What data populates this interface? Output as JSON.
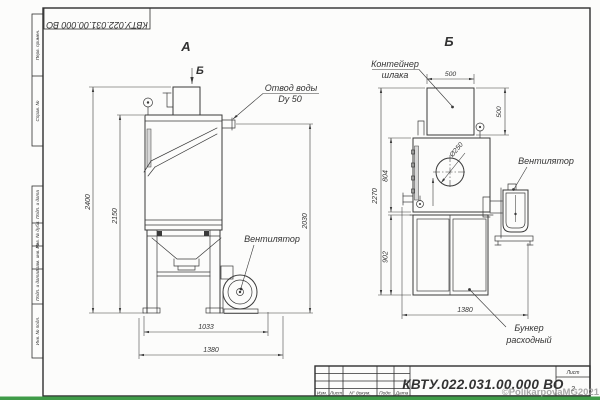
{
  "colors": {
    "line": "#3a3a3a",
    "green_bar": "#3f9b48"
  },
  "frame": {
    "top_stamp_code": "КВТУ.022.031.00.000  ВО",
    "left_top": [
      "Перв. примен.",
      "Справ. №"
    ],
    "left_bottom": [
      "Подп. и дата",
      "Инв. № дубл.",
      "Взам. инв. №",
      "Подп. и дата",
      "Инв. № подл."
    ]
  },
  "title_block": {
    "columns": [
      "Изм.",
      "Лист",
      "N° докум.",
      "Подп.",
      "Дата"
    ],
    "code": "КВТУ.022.031.00.000  ВО",
    "sheet_label": "Лист",
    "sheet_number": "2"
  },
  "watermark": "©PolikarpovaMG2021",
  "view_a": {
    "label": "А",
    "section_callout": "Б",
    "water_outlet": {
      "line1": "Отвод воды",
      "line2": "Dy 50"
    },
    "fan_label": "Вентилятор",
    "dim_total_height": "2400",
    "dim_tank_height": "2150",
    "dim_right_height": "2030",
    "dim_width_inner": "1033",
    "dim_width_total": "1380"
  },
  "view_b": {
    "label": "Б",
    "container": {
      "line1": "Контейнер",
      "line2": "шлака"
    },
    "fan_label": "Вентилятор",
    "bunker": {
      "line1": "Бункер",
      "line2": "расходный"
    },
    "dim_container_width": "500",
    "dim_container_height": "500",
    "dim_hole_diameter": "Ø250",
    "dim_body_height": "804",
    "dim_total_height": "2270",
    "dim_lower_height": "902",
    "dim_depth": "1380"
  }
}
